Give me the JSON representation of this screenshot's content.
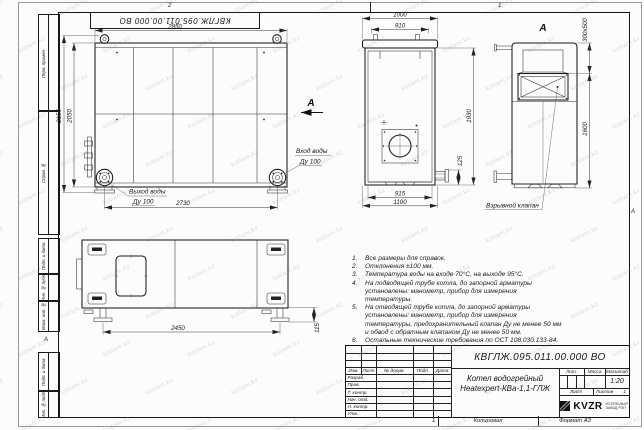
{
  "frame": {
    "stamp": "КВГЛЖ.095.011.00.000 ВО",
    "zones": {
      "top_left": "2",
      "top_right": "1",
      "bottom": "1",
      "left": "А",
      "right": "А"
    },
    "columns": [
      "Перв. примен.",
      "Справ. №",
      "Подп. и дата",
      "Инв. № дубл.",
      "Взам. инв. №",
      "Подп. и дата",
      "Инв. № подл."
    ],
    "watermark": "kotlam.kz",
    "copy_label": "Копировал",
    "format_label": "Формат А3"
  },
  "views": {
    "side": {
      "dim_width_top": "2850",
      "dim_height_outer": "2155",
      "dim_height_inner": "2050",
      "dim_width_bottom": "2730",
      "inlet_line1": "Вход воды",
      "inlet_line2": "Ду 100",
      "outlet_line1": "Выход воды",
      "outlet_line2": "Ду 100",
      "view_arrow_label": "А"
    },
    "front": {
      "dim_top_outer": "1000",
      "dim_top_inner": "910",
      "dim_height": "1930",
      "dim_stub": "125",
      "dim_bottom_inner": "915",
      "dim_bottom_outer": "1100"
    },
    "view_a": {
      "label": "А",
      "dim_valve": "300х500",
      "dim_height": "1600",
      "valve_label": "Взрывной клапан"
    },
    "plan": {
      "dim_width": "2450",
      "dim_foot": "115"
    }
  },
  "notes": [
    {
      "num": "1.",
      "text": "Все размеры для справок."
    },
    {
      "num": "2.",
      "text": "Отклонения ±100 мм."
    },
    {
      "num": "3.",
      "text": "Температура воды на входе 70°С, на выходе 95°С."
    },
    {
      "num": "4.",
      "text": "На подводящей трубе котла, до запорной арматуры установлены: манометр, прибор для измерения температуры."
    },
    {
      "num": "5.",
      "text": "На отводящей трубе котла, до запорной арматуры установлены: манометр, прибор для измерения температуры, предохранительный клапан Ду не менее 50 мм и обвод с обратным клапаном Ду не менее 50 мм."
    },
    {
      "num": "6.",
      "text": "Остальные технические требования по ОСТ 108.030.133-84."
    }
  ],
  "title_block": {
    "designation": "КВГЛЖ.095.011.00.000 ВО",
    "name_line1": "Котел водогрейный",
    "name_line2": "Heatexpert-КВа-1,1-ГЛЖ",
    "header_cols": [
      "Изм.",
      "Лист",
      "№ докум.",
      "Подп.",
      "Дата"
    ],
    "sign_rows": [
      "Разраб.",
      "Пров.",
      "Т. контр.",
      "Нач. отд.",
      "Н. контр.",
      "Утв."
    ],
    "lit_label": "Лит.",
    "mass_label": "Масса",
    "scale_label": "Масштаб",
    "scale_value": "1:20",
    "sheet_label": "Лист",
    "sheets_label": "Листов",
    "sheets_value": "1",
    "logo_text": "KVZR",
    "logo_sub1": "КОТЕЛЬНЫЙ",
    "logo_sub2": "ЗАВОД РЭП"
  }
}
